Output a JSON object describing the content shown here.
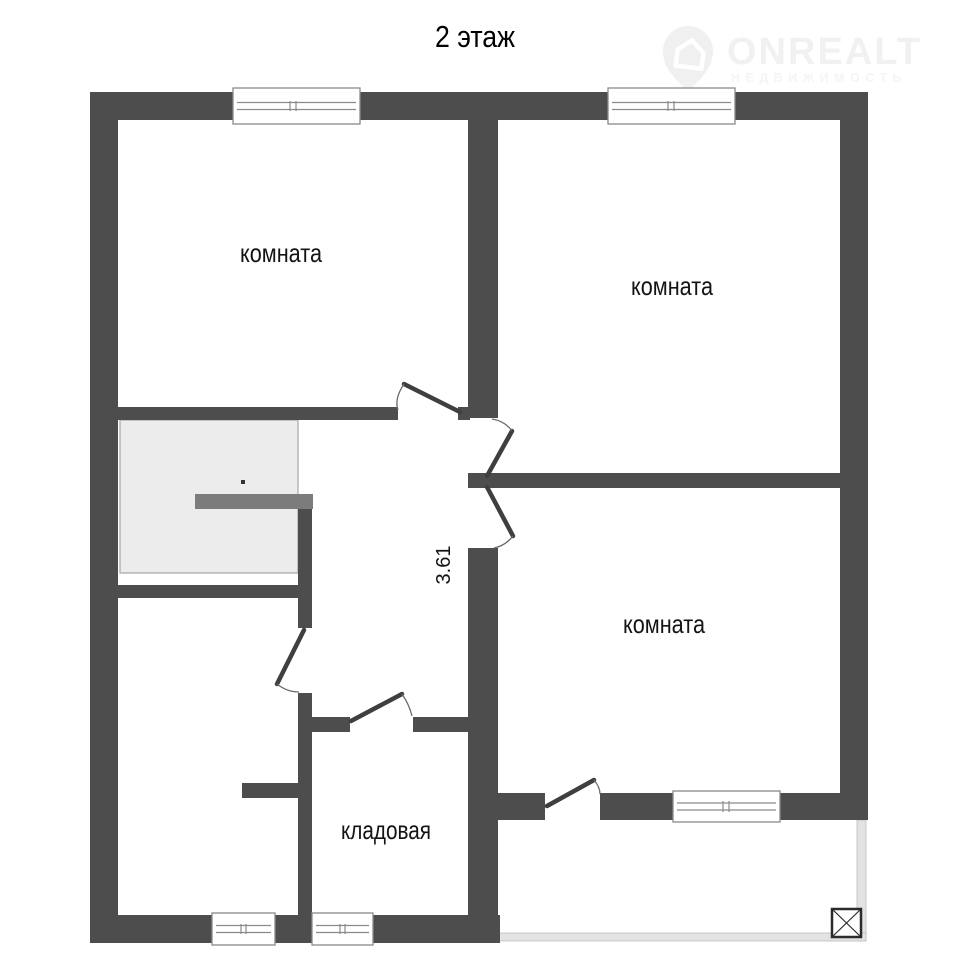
{
  "title": "2 этаж",
  "watermark": {
    "brand": "ONREALT",
    "tagline": "НЕДВИЖИМОСТЬ",
    "icon": "map-pin-house-icon"
  },
  "plan": {
    "rooms": [
      {
        "key": "room-top-left",
        "label": "комната"
      },
      {
        "key": "room-top-right",
        "label": "комната"
      },
      {
        "key": "room-middle-right",
        "label": "комната"
      },
      {
        "key": "storage-room",
        "label": "кладовая"
      }
    ],
    "dimension": {
      "value": "3.61"
    },
    "symbols": [
      "staircase",
      "stair-rail",
      "terrace-edge",
      "crossed-shaft-box",
      "window",
      "door-swing"
    ],
    "colors": {
      "wall": "#4d4d4d",
      "stair_fill": "#ececec",
      "stair_rail": "#7c7c7c",
      "terrace_edge": "#e3e3e3",
      "watermark": "#f1f1f1",
      "label_text": "#141414"
    }
  }
}
